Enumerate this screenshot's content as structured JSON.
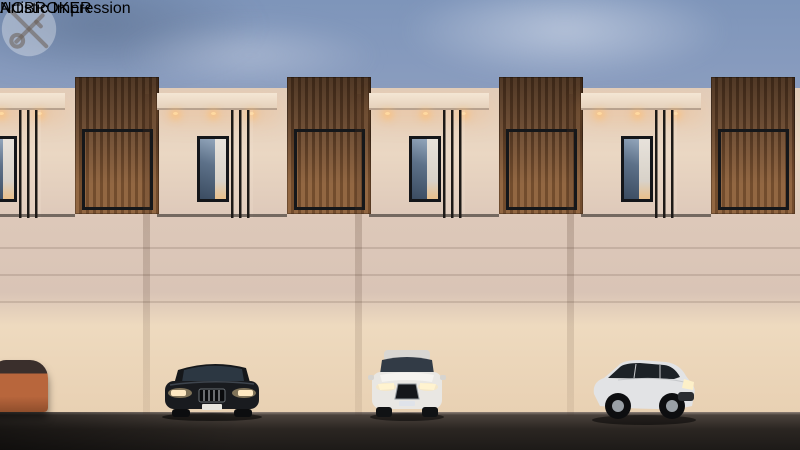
{
  "caption": {
    "text": "Artistic Impression"
  },
  "watermark": {
    "brand_text": "NOBROKER",
    "logo": "crossed-key-in-circle",
    "style": "translucent white overlay, centered"
  },
  "scene": {
    "setting": "Dusk exterior 3D render of a row of modern three-storey villas with warm interior lighting",
    "villa_count": 4,
    "villas": [
      {
        "left": -55
      },
      {
        "left": 157
      },
      {
        "left": 369
      },
      {
        "left": 581
      }
    ],
    "features": [
      "black steel rooftop pergola frames with angled slats and downlights",
      "rooftop hedge planters with occasional pink flowers",
      "vertical wood-slat clad balcony boxes with lit interiors and plants",
      "glass-railing balconies with potted plants",
      "X-beam up-down wall sconces on second floor",
      "cream facades, recessed lit canopies, dark framed windows",
      "front gardens with flowering bushes, trees, palms and bollard lights",
      "paved driveways meeting a dark asphalt road"
    ],
    "vehicles": [
      {
        "name": "orange-car-partial",
        "color": "#b8663c",
        "position": "far left edge"
      },
      {
        "name": "black-luxury-sedan",
        "color": "#17191d",
        "position": "left driveway"
      },
      {
        "name": "white-luxury-sedan",
        "color": "#e9e7e3",
        "position": "center driveway"
      },
      {
        "name": "white-hatchback",
        "color": "#e2e3e5",
        "position": "right driveway"
      }
    ],
    "palette": {
      "sky_top": "#7e95ba",
      "sky_horizon": "#d5c7c6",
      "facade_cream": "#ead7c3",
      "wood_slat": "#6b4a30",
      "frame_black": "#17181a",
      "warm_light": "#ffd9a0",
      "foliage": "#4a6135",
      "road": "#241f1c"
    }
  }
}
